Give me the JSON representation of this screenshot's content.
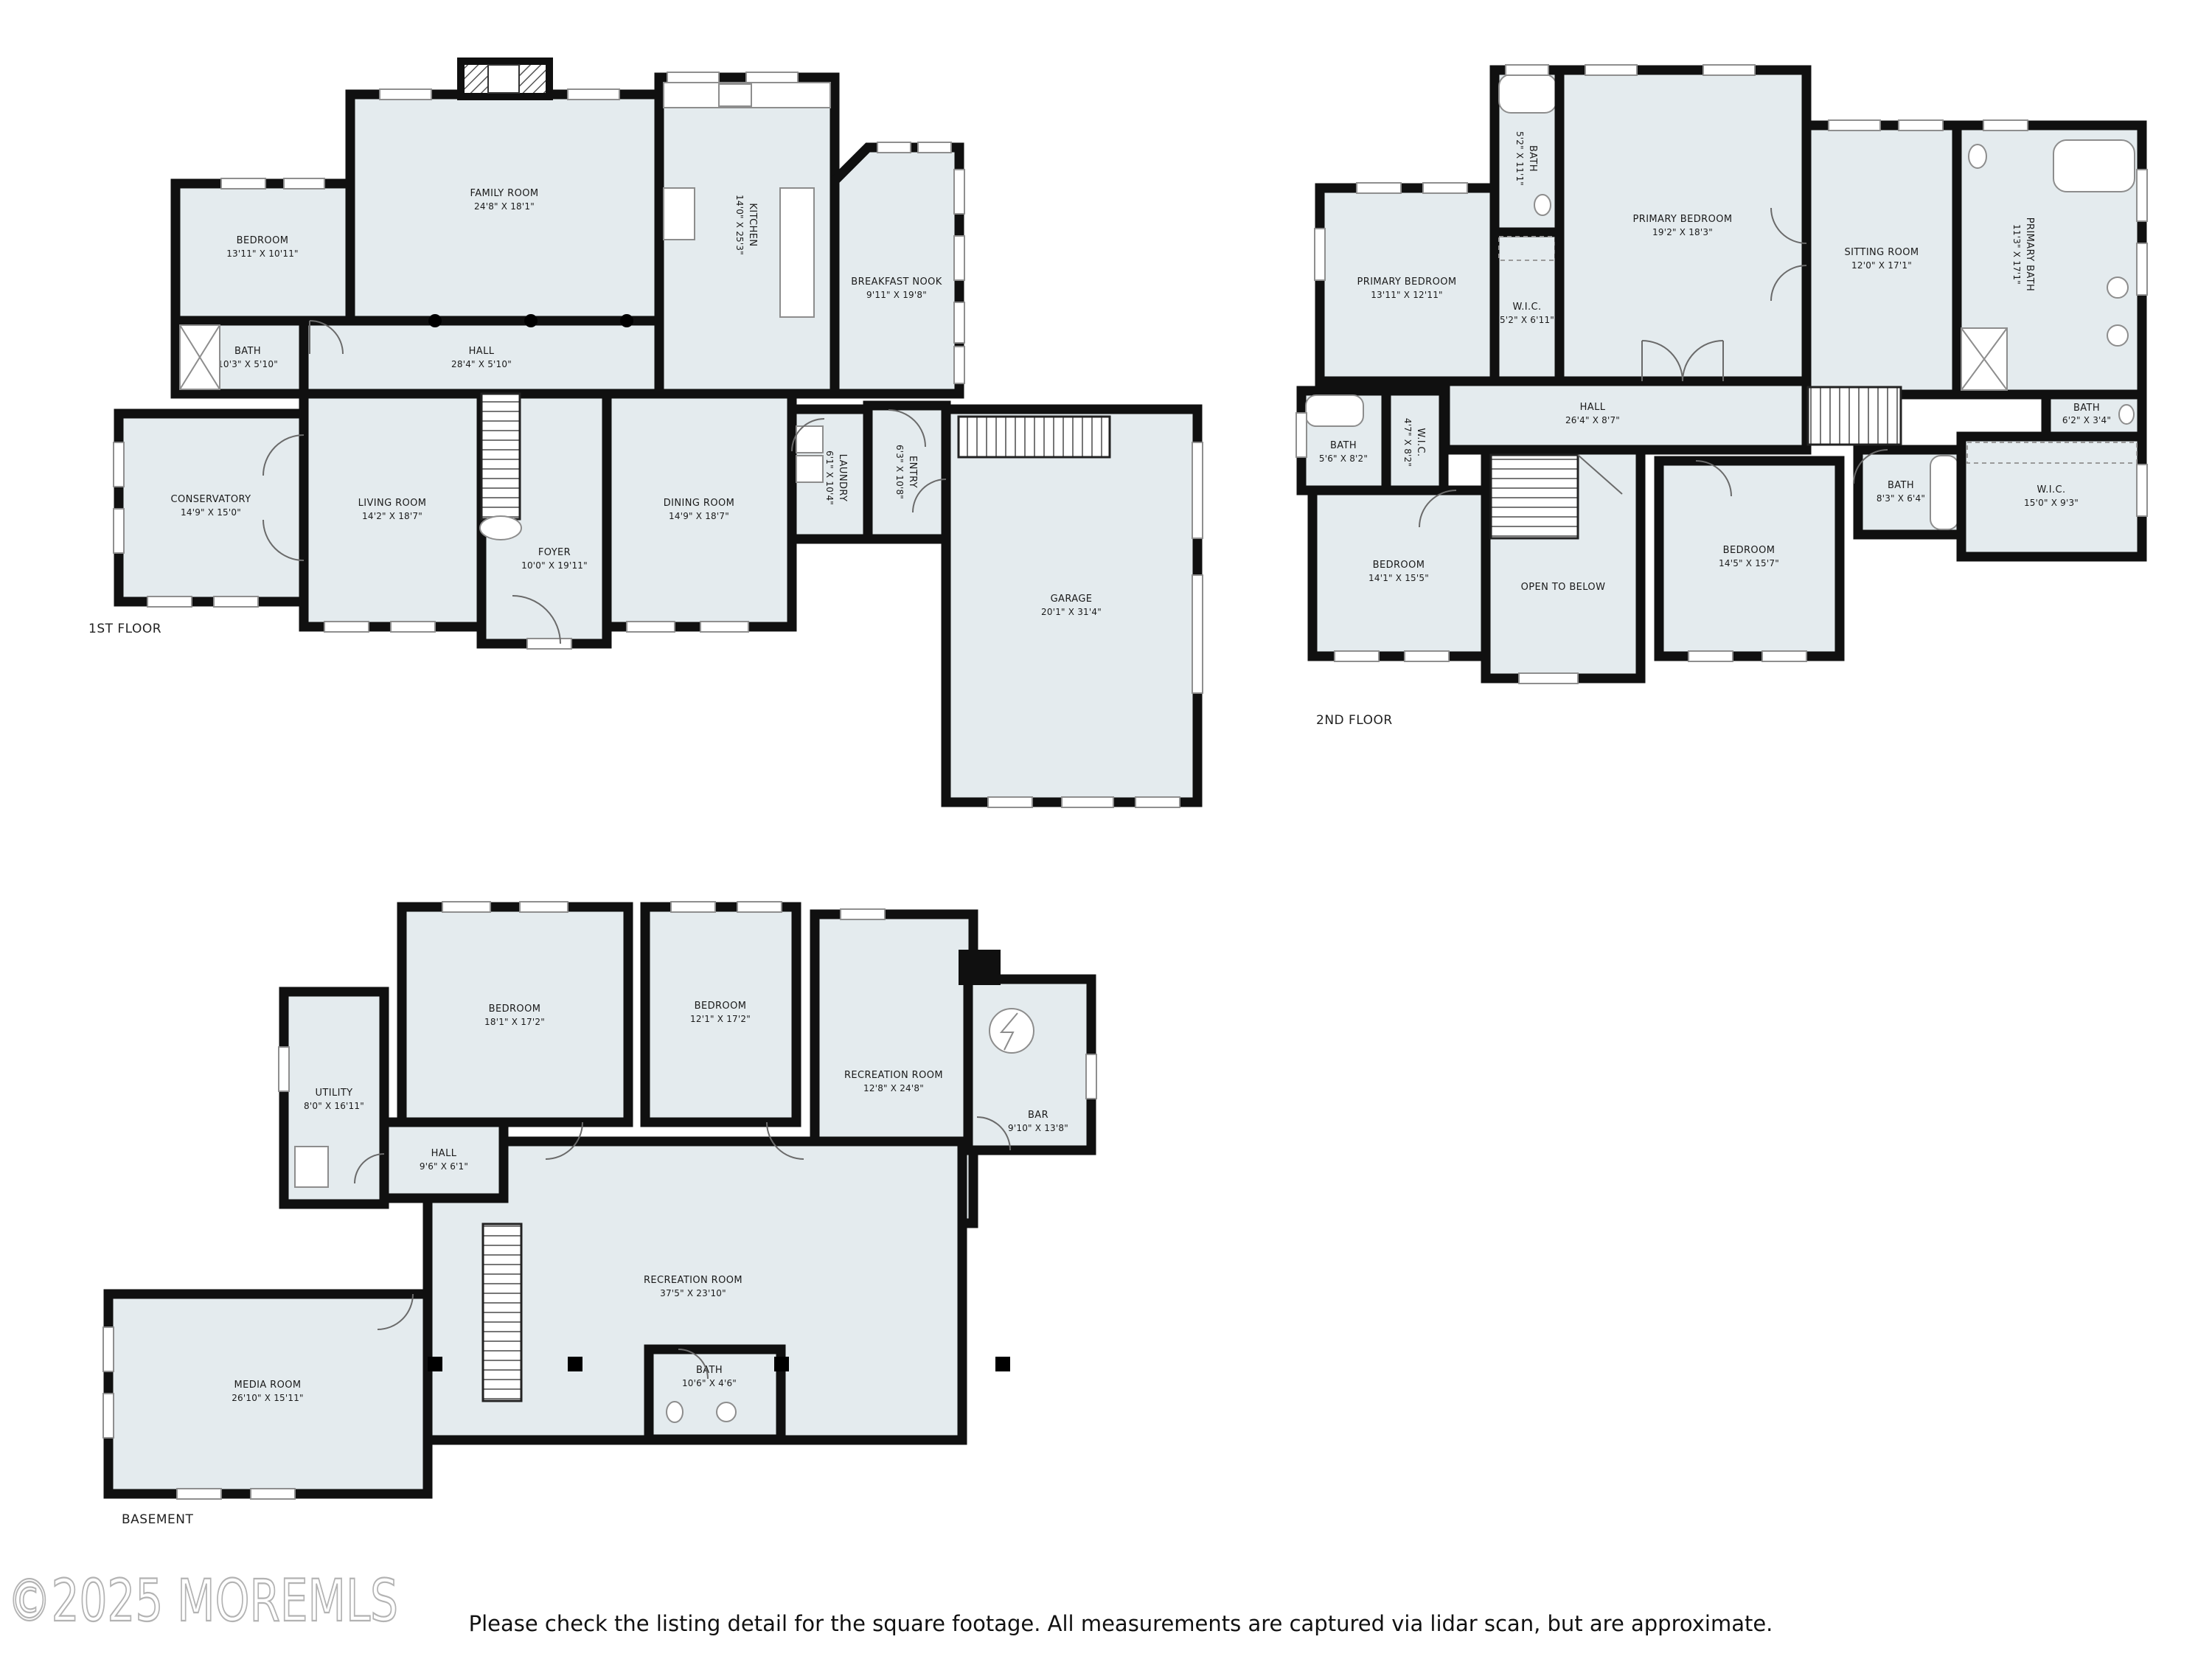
{
  "colors": {
    "background": "#ffffff",
    "room_fill": "#e4ebee",
    "wall": "#101010",
    "fixture_stroke": "#8d8d8d",
    "text": "#1a1a1a",
    "watermark": "#b3b3b3"
  },
  "floors": [
    {
      "label": "1ST FLOOR",
      "rooms": [
        {
          "name": "BEDROOM",
          "dims": "13'11\" X 10'11\""
        },
        {
          "name": "BATH",
          "dims": "10'3\" X 5'10\""
        },
        {
          "name": "FAMILY ROOM",
          "dims": "24'8\" X 18'1\""
        },
        {
          "name": "HALL",
          "dims": "28'4\" X 5'10\""
        },
        {
          "name": "KITCHEN",
          "dims": "14'0\" X 25'3\""
        },
        {
          "name": "BREAKFAST NOOK",
          "dims": "9'11\" X 19'8\""
        },
        {
          "name": "LIVING ROOM",
          "dims": "14'2\" X 18'7\""
        },
        {
          "name": "CONSERVATORY",
          "dims": "14'9\" X 15'0\""
        },
        {
          "name": "FOYER",
          "dims": "10'0\" X 19'11\""
        },
        {
          "name": "DINING ROOM",
          "dims": "14'9\" X 18'7\""
        },
        {
          "name": "LAUNDRY",
          "dims": "6'1\" X 10'4\""
        },
        {
          "name": "ENTRY",
          "dims": "6'3\" X 10'8\""
        },
        {
          "name": "GARAGE",
          "dims": "20'1\" X 31'4\""
        }
      ]
    },
    {
      "label": "2ND FLOOR",
      "rooms": [
        {
          "name": "PRIMARY BEDROOM",
          "dims": "13'11\" X 12'11\""
        },
        {
          "name": "BATH",
          "dims": "5'2\" X 11'1\""
        },
        {
          "name": "W.I.C.",
          "dims": "5'2\" X 6'11\""
        },
        {
          "name": "PRIMARY BEDROOM",
          "dims": "19'2\" X 18'3\""
        },
        {
          "name": "SITTING ROOM",
          "dims": "12'0\" X 17'1\""
        },
        {
          "name": "PRIMARY BATH",
          "dims": "11'3\" X 17'1\""
        },
        {
          "name": "HALL",
          "dims": "26'4\" X 8'7\""
        },
        {
          "name": "BATH",
          "dims": "5'6\" X 8'2\""
        },
        {
          "name": "W.I.C.",
          "dims": "4'7\" X 8'2\""
        },
        {
          "name": "BATH",
          "dims": "6'2\" X 3'4\""
        },
        {
          "name": "BATH",
          "dims": "8'3\" X 6'4\""
        },
        {
          "name": "W.I.C.",
          "dims": "15'0\" X 9'3\""
        },
        {
          "name": "BEDROOM",
          "dims": "14'1\" X 15'5\""
        },
        {
          "name": "OPEN TO BELOW",
          "dims": ""
        },
        {
          "name": "BEDROOM",
          "dims": "14'5\" X 15'7\""
        }
      ]
    },
    {
      "label": "BASEMENT",
      "rooms": [
        {
          "name": "UTILITY",
          "dims": "8'0\" X 16'11\""
        },
        {
          "name": "BEDROOM",
          "dims": "18'1\" X 17'2\""
        },
        {
          "name": "BEDROOM",
          "dims": "12'1\" X 17'2\""
        },
        {
          "name": "RECREATION ROOM",
          "dims": "12'8\" X 24'8\""
        },
        {
          "name": "BAR",
          "dims": "9'10\" X 13'8\""
        },
        {
          "name": "RECREATION ROOM",
          "dims": "37'5\" X 23'10\""
        },
        {
          "name": "HALL",
          "dims": "9'6\" X 6'1\""
        },
        {
          "name": "MEDIA ROOM",
          "dims": "26'10\" X 15'11\""
        },
        {
          "name": "BATH",
          "dims": "10'6\" X 4'6\""
        }
      ]
    }
  ],
  "footer": {
    "watermark": "©2025 MOREMLS",
    "disclaimer": "Please check the listing detail for the square footage. All measurements are captured via lidar scan, but are approximate."
  }
}
